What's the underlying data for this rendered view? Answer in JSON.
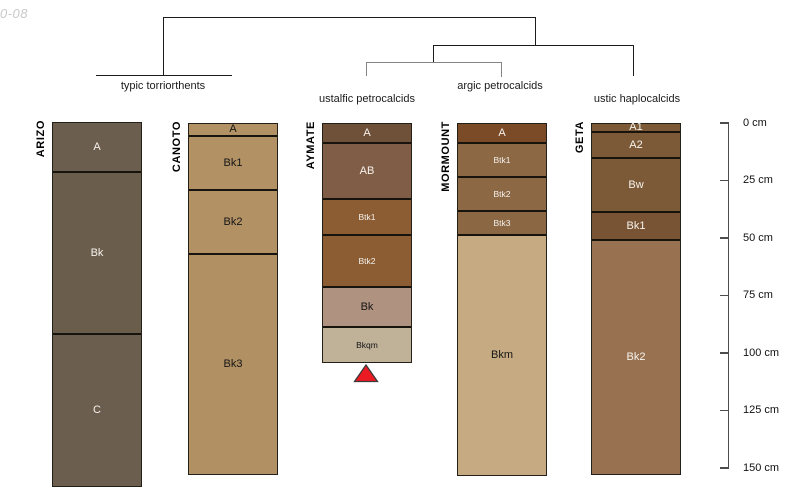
{
  "watermark": "0-08",
  "dendrogram": {
    "cluster_labels": [
      {
        "text": "typic torriorthents",
        "x": 163,
        "y": 80
      },
      {
        "text": "ustalfic petrocalcids",
        "x": 367,
        "y": 93
      },
      {
        "text": "argic petrocalcids",
        "x": 500,
        "y": 80
      },
      {
        "text": "ustic haplocalcids",
        "x": 637,
        "y": 93
      }
    ]
  },
  "depth_scale": {
    "unit": "cm",
    "axis_x": 728,
    "top_y": 123,
    "bottom_y": 468,
    "max_depth": 150,
    "label_x": 743,
    "ticks": [
      {
        "label": "0 cm",
        "depth": 0
      },
      {
        "label": "25 cm",
        "depth": 25
      },
      {
        "label": "50 cm",
        "depth": 50
      },
      {
        "label": "75 cm",
        "depth": 75
      },
      {
        "label": "100 cm",
        "depth": 100
      },
      {
        "label": "125 cm",
        "depth": 125
      },
      {
        "label": "150 cm",
        "depth": 150
      }
    ]
  },
  "profiles": [
    {
      "name": "ARIZO",
      "x": 52,
      "width": 88,
      "top": 122,
      "horizons": [
        {
          "label": "A",
          "bottom_y": 170,
          "depth_cm": [
            0,
            20
          ],
          "color": "#6c5e4e",
          "text_color": "#f5f2ec",
          "small": false
        },
        {
          "label": "Bk",
          "bottom_y": 332,
          "depth_cm": [
            20,
            91
          ],
          "color": "#6b5d4c",
          "text_color": "#f5f2ec",
          "small": false
        },
        {
          "label": "C",
          "bottom_y": 485,
          "depth_cm": [
            91,
            157
          ],
          "color": "#6c5e4e",
          "text_color": "#f5f2ec",
          "small": false
        }
      ]
    },
    {
      "name": "CANOTO",
      "x": 188,
      "width": 88,
      "top": 123,
      "horizons": [
        {
          "label": "A",
          "bottom_y": 134,
          "depth_cm": [
            0,
            5
          ],
          "color": "#b29164",
          "text_color": "#161616",
          "small": false
        },
        {
          "label": "Bk1",
          "bottom_y": 188,
          "depth_cm": [
            5,
            28
          ],
          "color": "#b29164",
          "text_color": "#161616",
          "small": false
        },
        {
          "label": "Bk2",
          "bottom_y": 252,
          "depth_cm": [
            28,
            56
          ],
          "color": "#b29164",
          "text_color": "#161616",
          "small": false
        },
        {
          "label": "Bk3",
          "bottom_y": 473,
          "depth_cm": [
            56,
            152
          ],
          "color": "#b19063",
          "text_color": "#161616",
          "small": false
        }
      ]
    },
    {
      "name": "AYMATE",
      "x": 322,
      "width": 88,
      "top": 123,
      "horizons": [
        {
          "label": "A",
          "bottom_y": 141,
          "depth_cm": [
            0,
            8
          ],
          "color": "#6f5039",
          "text_color": "#f5f2ec",
          "small": false
        },
        {
          "label": "AB",
          "bottom_y": 197,
          "depth_cm": [
            8,
            32
          ],
          "color": "#7f5d46",
          "text_color": "#f5f2ec",
          "small": false
        },
        {
          "label": "Btk1",
          "bottom_y": 233,
          "depth_cm": [
            32,
            48
          ],
          "color": "#8c5c33",
          "text_color": "#f5f2ec",
          "small": true
        },
        {
          "label": "Btk2",
          "bottom_y": 285,
          "depth_cm": [
            48,
            70
          ],
          "color": "#8c5c33",
          "text_color": "#f5f2ec",
          "small": true
        },
        {
          "label": "Bk",
          "bottom_y": 325,
          "depth_cm": [
            70,
            88
          ],
          "color": "#af927f",
          "text_color": "#161616",
          "small": false
        },
        {
          "label": "Bkqm",
          "bottom_y": 361,
          "depth_cm": [
            88,
            103
          ],
          "color": "#c0b199",
          "text_color": "#161616",
          "small": true
        }
      ]
    },
    {
      "name": "MORMOUNT",
      "x": 457,
      "width": 88,
      "top": 123,
      "horizons": [
        {
          "label": "A",
          "bottom_y": 141,
          "depth_cm": [
            0,
            8
          ],
          "color": "#7b4b27",
          "text_color": "#f5f2ec",
          "small": false
        },
        {
          "label": "Btk1",
          "bottom_y": 175,
          "depth_cm": [
            8,
            23
          ],
          "color": "#8c6845",
          "text_color": "#f5f2ec",
          "small": true
        },
        {
          "label": "Btk2",
          "bottom_y": 209,
          "depth_cm": [
            23,
            37
          ],
          "color": "#8c6845",
          "text_color": "#f5f2ec",
          "small": true
        },
        {
          "label": "Btk3",
          "bottom_y": 233,
          "depth_cm": [
            37,
            48
          ],
          "color": "#8b6744",
          "text_color": "#f5f2ec",
          "small": true
        },
        {
          "label": "Bkm",
          "bottom_y": 474,
          "depth_cm": [
            48,
            153
          ],
          "color": "#c6ab82",
          "text_color": "#161616",
          "small": false
        }
      ]
    },
    {
      "name": "GETA",
      "x": 591,
      "width": 88,
      "top": 123,
      "horizons": [
        {
          "label": "A1",
          "bottom_y": 130,
          "depth_cm": [
            0,
            3
          ],
          "color": "#7d5a37",
          "text_color": "#f5f2ec",
          "small": false
        },
        {
          "label": "A2",
          "bottom_y": 156,
          "depth_cm": [
            3,
            14
          ],
          "color": "#7d5a37",
          "text_color": "#f5f2ec",
          "small": false
        },
        {
          "label": "Bw",
          "bottom_y": 210,
          "depth_cm": [
            14,
            38
          ],
          "color": "#7d5a37",
          "text_color": "#f5f2ec",
          "small": false
        },
        {
          "label": "Bk1",
          "bottom_y": 238,
          "depth_cm": [
            38,
            50
          ],
          "color": "#795434",
          "text_color": "#f5f2ec",
          "small": false
        },
        {
          "label": "Bk2",
          "bottom_y": 473,
          "depth_cm": [
            50,
            152
          ],
          "color": "#987250",
          "text_color": "#f5f2ec",
          "small": false
        }
      ]
    }
  ],
  "marker": {
    "profile": "AYMATE",
    "fill": "#ec1b23",
    "stroke": "#3a3a3a"
  }
}
